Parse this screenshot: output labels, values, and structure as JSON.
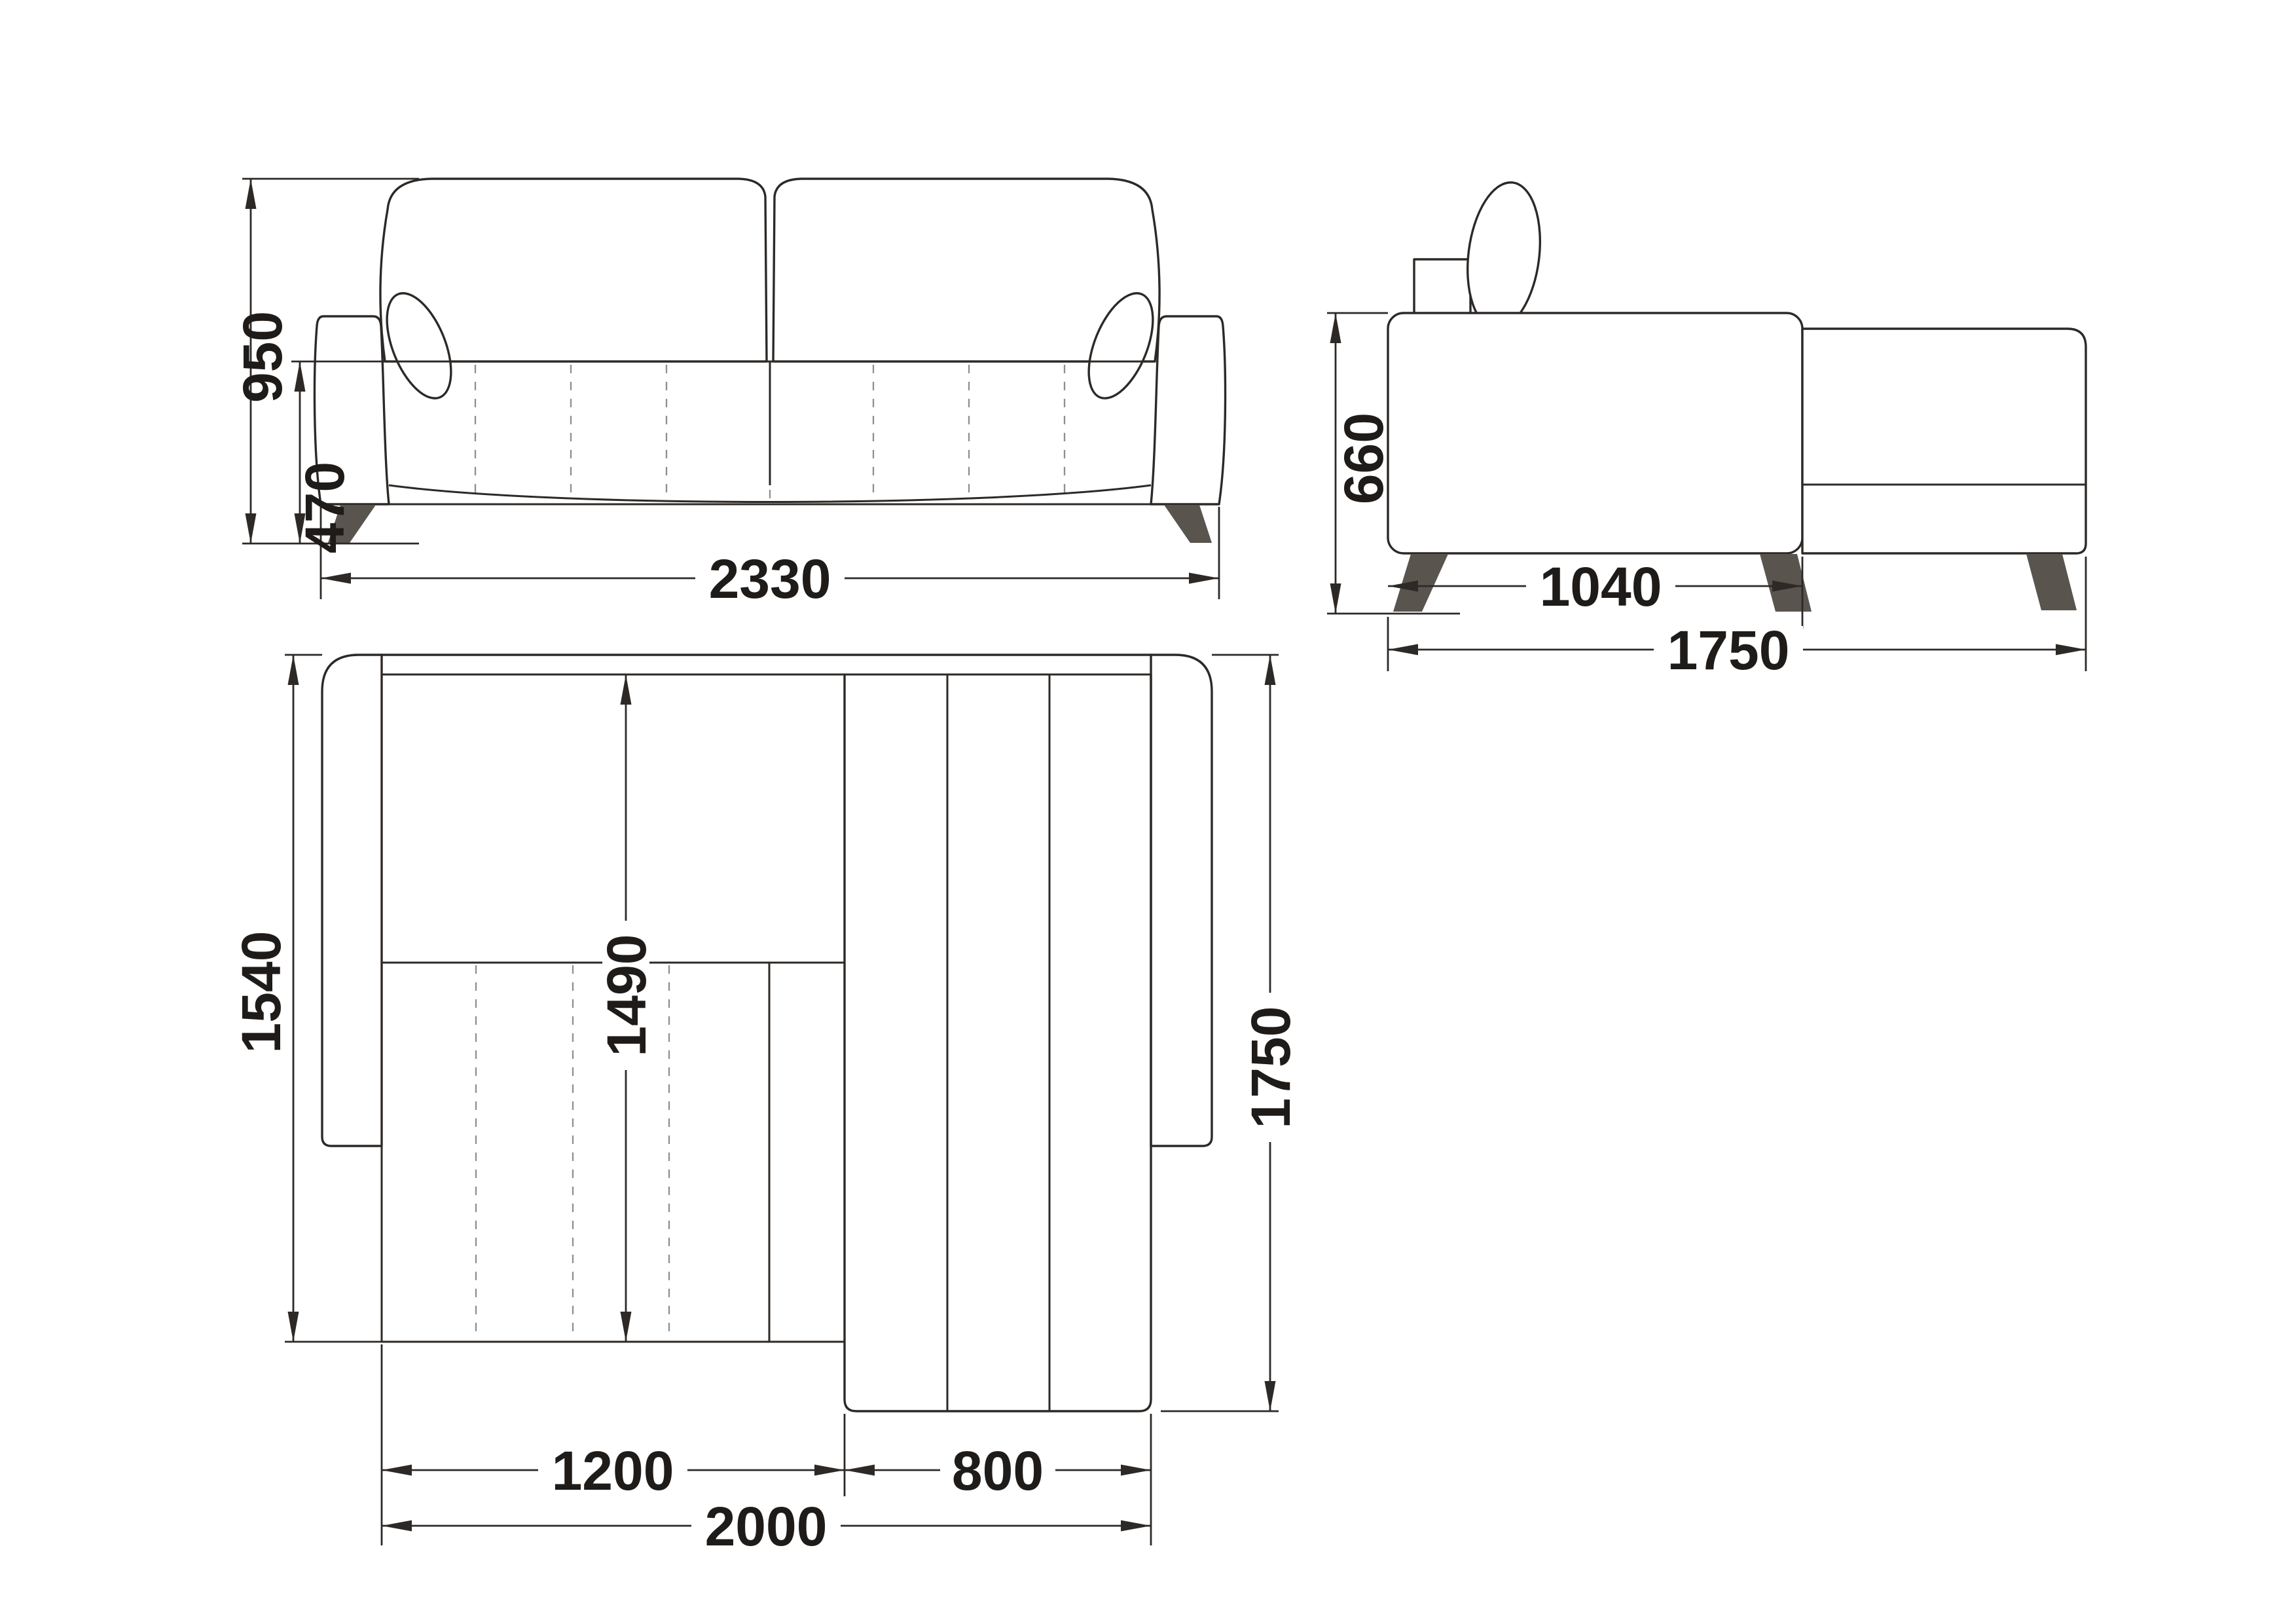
{
  "drawing": {
    "title": "corner-sofa-dimension-drawing",
    "background": "#ffffff",
    "line_color": "#2d2926",
    "leg_color": "#5a544f",
    "dash_color": "#8f8f8f",
    "text_color": "#1e1b19",
    "label_bg": "#ffffff"
  },
  "views": {
    "front": {
      "name": "front-elevation",
      "dims": {
        "overall_height": "950",
        "seat_height": "470",
        "overall_width": "2330"
      }
    },
    "side": {
      "name": "side-elevation",
      "dims": {
        "back_height": "660",
        "seat_section_depth": "1040",
        "overall_depth": "1750"
      }
    },
    "top": {
      "name": "plan-view",
      "dims": {
        "body_depth": "1540",
        "bed_length": "1490",
        "overall_depth": "1750",
        "seat_section_width": "1200",
        "chaise_width": "800",
        "bed_width": "2000"
      }
    }
  }
}
